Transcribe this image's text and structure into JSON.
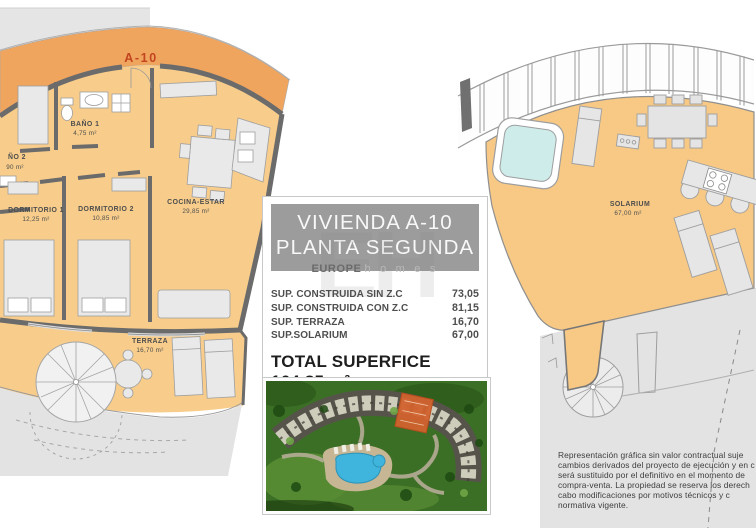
{
  "left_plan": {
    "unit_marker": "A-10",
    "rooms": [
      {
        "name": "BAÑO 1",
        "area": "4,75 m²"
      },
      {
        "name": "ÑO 2",
        "area": "90 m²"
      },
      {
        "name": "DORMITORIO 1",
        "area": "12,25 m²"
      },
      {
        "name": "DORMITORIO 2",
        "area": "10,85 m²"
      },
      {
        "name": "COCINA-ESTAR",
        "area": "29,85 m²"
      },
      {
        "name": "TERRAZA",
        "area": "16,70 m²"
      }
    ]
  },
  "right_plan": {
    "rooms": [
      {
        "name": "SOLARIUM",
        "area": "67,00 m²"
      }
    ]
  },
  "panel": {
    "title_line1": "VIVIENDA A-10",
    "title_line2": "PLANTA SEGUNDA",
    "watermark_monogram": "EH",
    "watermark_bold": "EUROPE",
    "watermark_light": "h o m e s",
    "measurements": [
      {
        "label": "SUP. CONSTRUIDA SIN Z.C",
        "value": "73,05"
      },
      {
        "label": "SUP. CONSTRUIDA CON Z.C",
        "value": "81,15"
      },
      {
        "label": "SUP. TERRAZA",
        "value": "16,70"
      },
      {
        "label": "SUP.SOLARIUM",
        "value": "67,00"
      }
    ],
    "total_label": "TOTAL SUPERFICE",
    "total_value": "164,85 m²"
  },
  "photo": {
    "alt": "aerial-render-residential-complex-pool-highlighted-unit"
  },
  "disclaimer": {
    "lines": [
      "Representación gráfica sin valor contractual suje",
      "cambios derivados del proyecto de ejecución y en c",
      "será sustituido por el definitivo en el momento de ",
      "compra-venta. La propiedad se reserva los derech",
      "cabo modificaciones por motivos técnicos y c",
      "normativa vigente."
    ]
  },
  "colors": {
    "floor_orange": "#f8cd8b",
    "band_orange": "#f0a55f",
    "marker_red": "#c2451f",
    "wall_gray": "#6b6b6b",
    "jacuzzi_cyan": "#cdecea",
    "banner_gray": "#9c9c9c",
    "exterior_gray": "#e3e3e3",
    "pool_blue": "#3fb4dc",
    "highlight_unit_orange": "#d2622e"
  }
}
